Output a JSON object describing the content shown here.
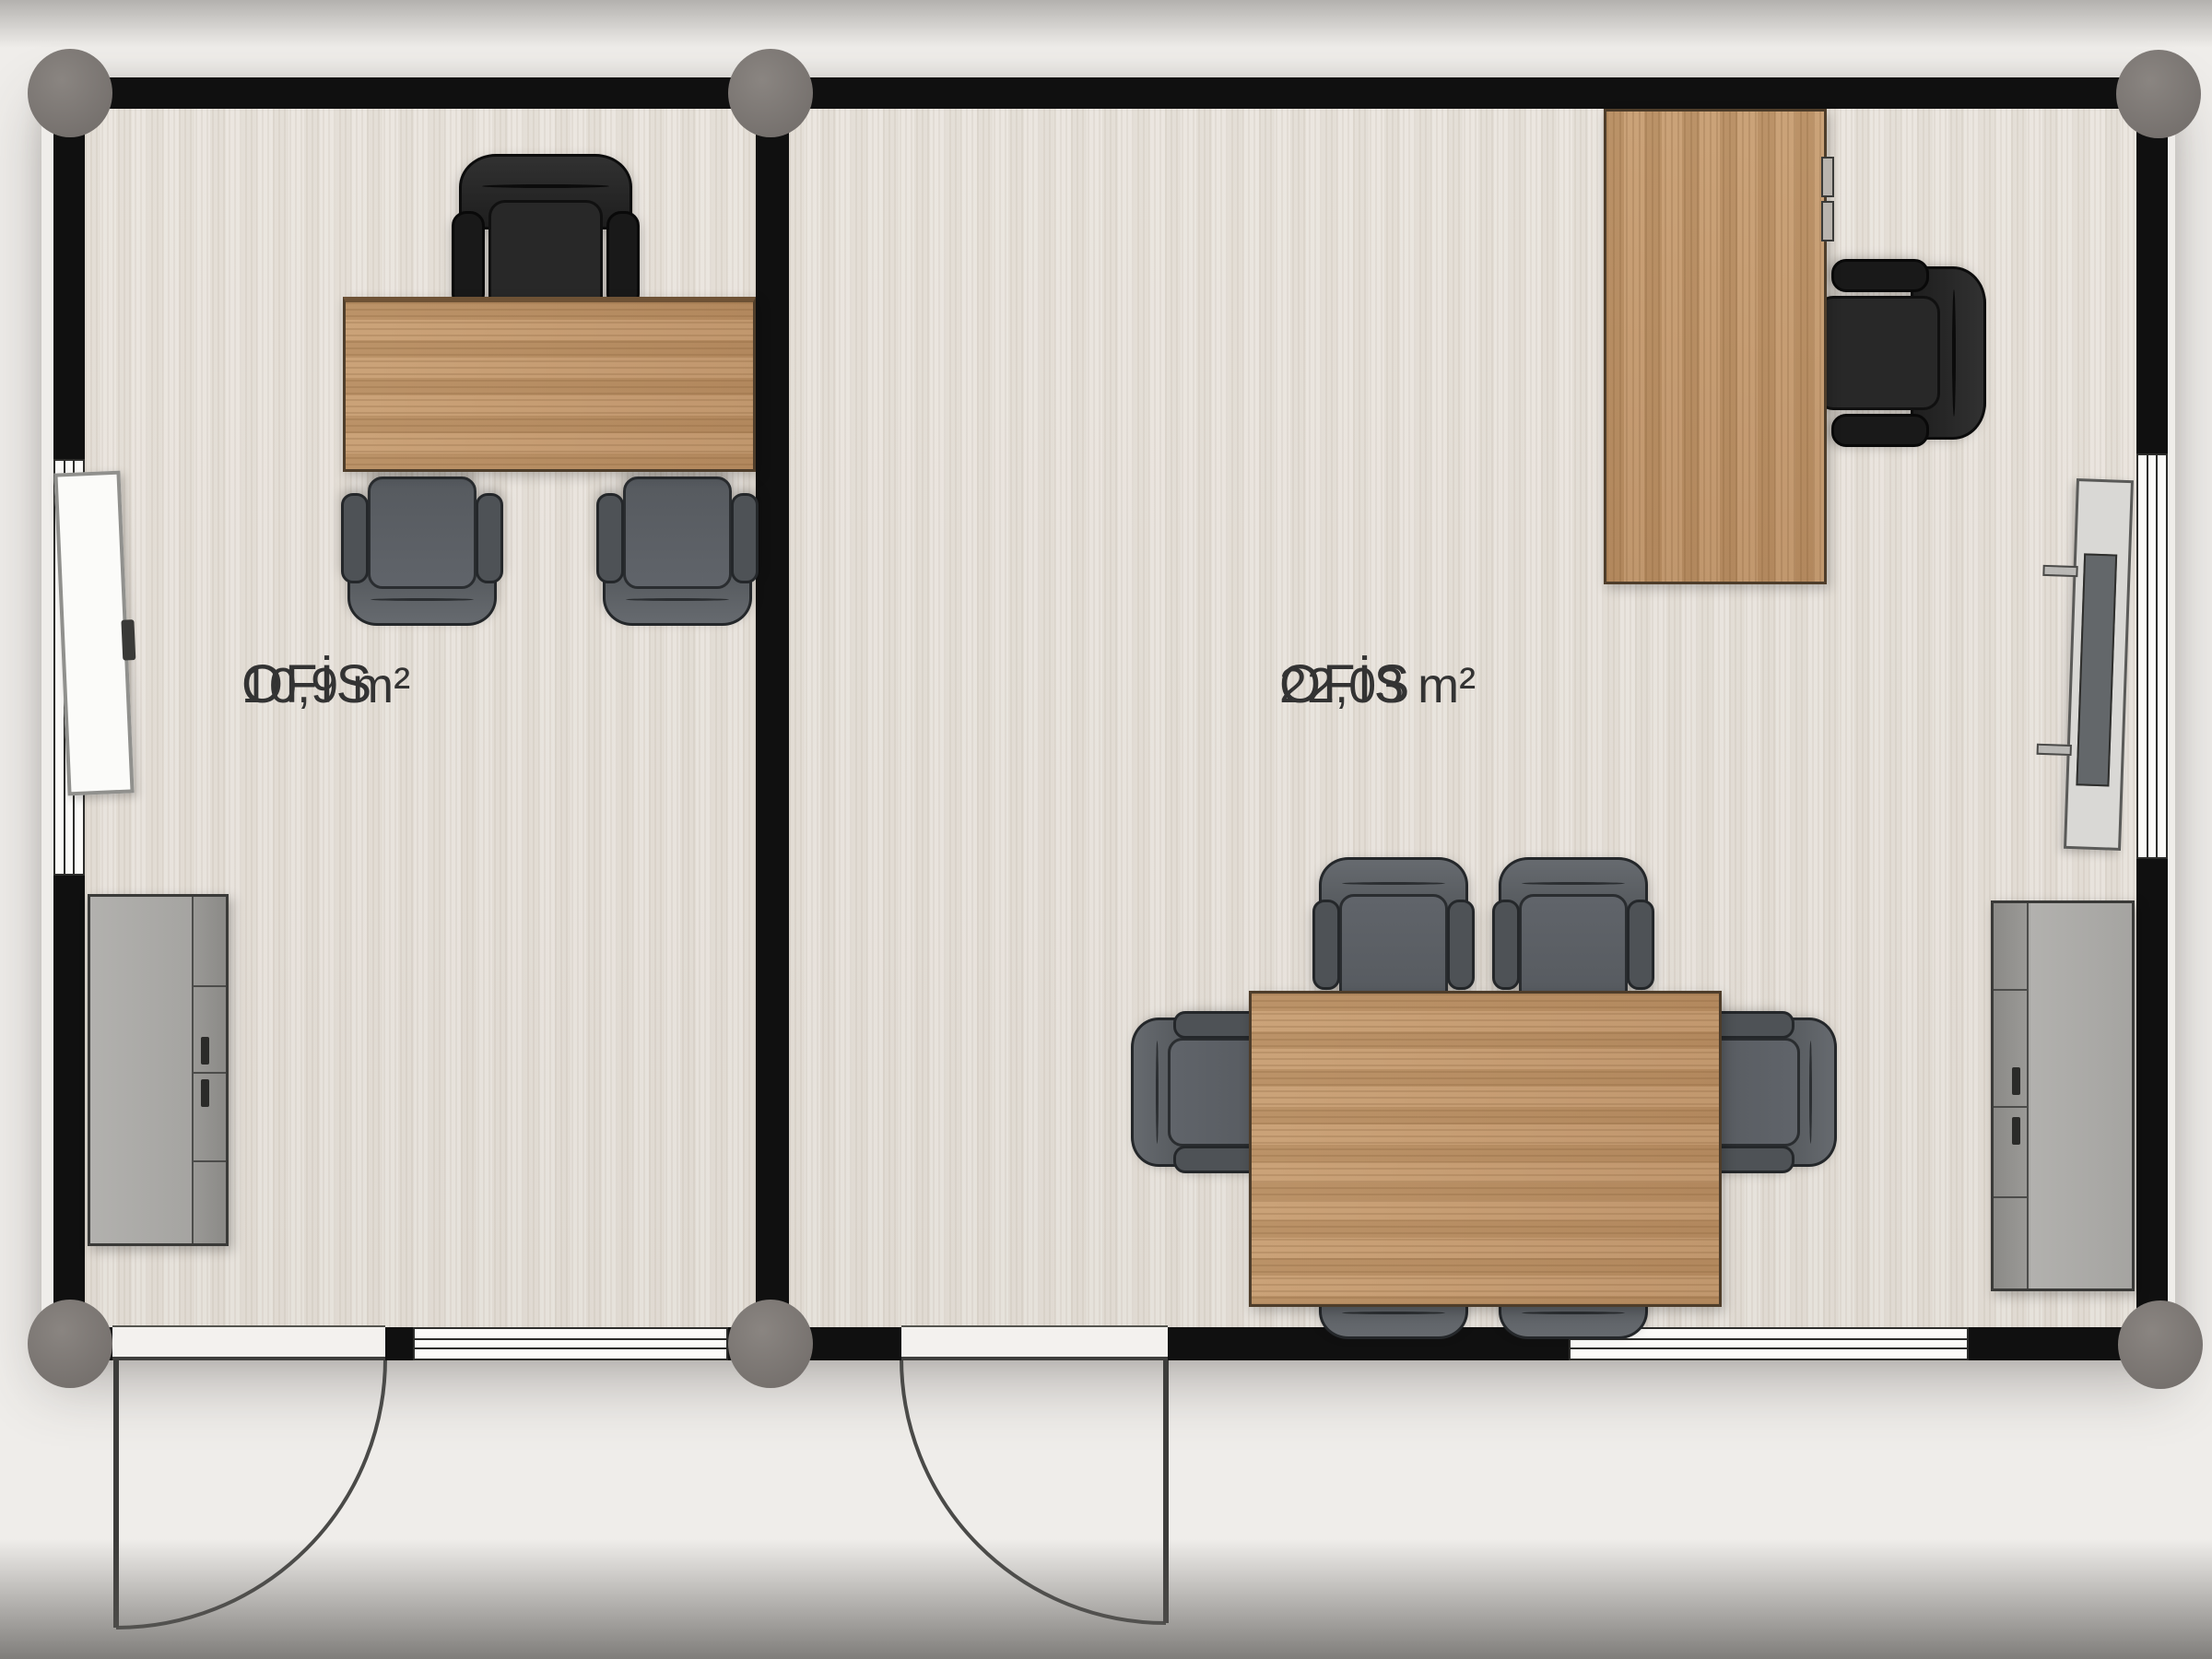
{
  "plan": {
    "type": "floor-plan",
    "rooms": [
      {
        "name": "OFİS",
        "area": "10,9 m²",
        "furniture": [
          "office-desk",
          "executive-chair",
          "guest-chair",
          "guest-chair",
          "whiteboard",
          "storage-cabinet"
        ],
        "openings": [
          "entrance-door",
          "window-left-wall",
          "window-bottom-wall"
        ]
      },
      {
        "name": "OFİS",
        "area": "22,03 m²",
        "furniture": [
          "office-desk",
          "executive-chair",
          "meeting-table",
          "meeting-chair",
          "meeting-chair",
          "meeting-chair",
          "meeting-chair",
          "meeting-chair",
          "meeting-chair",
          "tv-screen",
          "storage-cabinet"
        ],
        "openings": [
          "entrance-door",
          "window-right-wall",
          "window-bottom-wall"
        ]
      }
    ]
  },
  "colors": {
    "wall": "#101010",
    "floor": "#e8e3dc",
    "background": "#efedea",
    "wood": "#c49a6d",
    "chair_black": "#262626",
    "chair_gray": "#5a5e62",
    "post_gray": "#7e7975",
    "cabinet_gray": "#abaaa7",
    "label_text": "#333333"
  }
}
